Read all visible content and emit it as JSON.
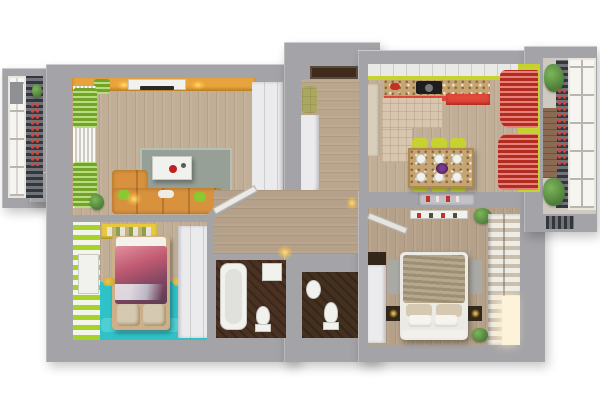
{
  "scene": {
    "kind": "3d-floor-plan-top-down-render",
    "description": "Photorealistic top-down 3D render of a two-bedroom apartment with two balconies",
    "background": "#ffffff"
  },
  "palette": {
    "wall": "#a4a4a8",
    "wall_light": "#c6c6ca",
    "niche": "#c2c2c6",
    "floor_wood": "#c1ae96",
    "floor_wood_dark": "#b5a189",
    "floor_entry": "#b9a68d",
    "accent_orange": "#e8a43c",
    "lime": "#8cc832",
    "lime_wall": "#c6d230",
    "teal_floor": "#2fc2c6",
    "teal_rug": "#5cd4d6",
    "coral_cabinet": "#e0483a",
    "curtain_red": "#d93528",
    "granite": "#c7a572",
    "tile_beige": "#d8c6ae",
    "dark_brown_room": "#4a3122",
    "dark_brown_wc": "#44301f",
    "door_brown": "#3e2b1c",
    "fixture_white": "#f1f1ee",
    "furniture_white": "#ebebee",
    "sofa_orange": "#d8923e",
    "bed_duvet_beige": "#b2a489",
    "pillow_tan": "#d6c9b2",
    "rug_grey": "#96a096",
    "rug_grey_plain": "#a9a9a5",
    "nightstand_dark": "#322718",
    "shelf_yellow": "#e5c93e",
    "bench_olive": "#a9a85e",
    "balcony_left_bg": "#dddbd5",
    "balcony_right_bg": "#cfc9c0",
    "brick": "#8a6a52",
    "kids_duvet": "#b05a6e",
    "window_light": "#fdf3da",
    "cabinet_beige": "#d9ceba"
  },
  "rooms": [
    {
      "name": "balcony-left",
      "furniture": [
        "window-panes",
        "lattice-railing",
        "climbing-flowers",
        "plant",
        "grey-panel"
      ]
    },
    {
      "name": "living-room",
      "furniture": [
        "orange-accent-wall",
        "tv-console",
        "tv",
        "wall-light",
        "sheer-curtain",
        "green-curtains",
        "corner-sofa",
        "green-pillows",
        "floor-lamp",
        "coffee-table",
        "red-bowl",
        "rug",
        "plant",
        "open-door"
      ]
    },
    {
      "name": "kids-room",
      "furniture": [
        "lime-striped-wall",
        "radiator",
        "book-shelf",
        "bed-with-print-duvet",
        "pillows",
        "teal-floor",
        "text-rug",
        "wall-decals",
        "wardrobe"
      ]
    },
    {
      "name": "entrance-hall",
      "furniture": [
        "entry-door",
        "upholstered-bench",
        "built-in-wardrobe",
        "curved-closet",
        "ceiling-lamp"
      ]
    },
    {
      "name": "hallway",
      "furniture": [
        "open-door-to-living",
        "open-door-to-bedroom",
        "wall-lamp"
      ]
    },
    {
      "name": "bathroom",
      "furniture": [
        "bathtub",
        "washing-machine",
        "toilet"
      ]
    },
    {
      "name": "wc",
      "furniture": [
        "wash-basin",
        "toilet"
      ]
    },
    {
      "name": "kitchen-dining",
      "furniture": [
        "upper-cabinets",
        "coral-lower-cabinets",
        "granite-countertop",
        "cooktop",
        "pot",
        "tall-cabinet",
        "tile-mat",
        "dining-table",
        "six-plates",
        "flower-centerpiece",
        "lime-chairs",
        "red-curtains",
        "lime-accent-wall",
        "wall-niche-shelf"
      ]
    },
    {
      "name": "bedroom",
      "furniture": [
        "double-bed",
        "striped-duvet",
        "four-pillows",
        "foot-bench",
        "nightstands",
        "bedside-lamps",
        "bedside-rugs",
        "dark-top-wardrobe",
        "open-shelving",
        "wall-shelf",
        "plants",
        "window-light"
      ]
    },
    {
      "name": "balcony-right",
      "furniture": [
        "window-panes",
        "lattice-railing",
        "climbing-flowers",
        "plants",
        "brick-wall",
        "radiator"
      ]
    }
  ]
}
